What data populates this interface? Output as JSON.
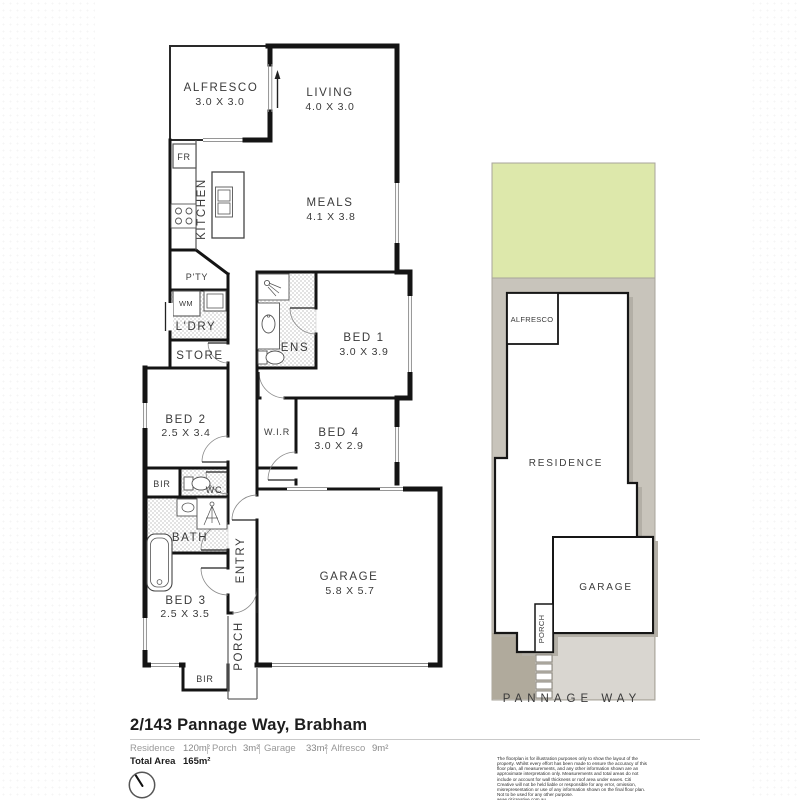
{
  "floorplan": {
    "alfresco": {
      "name": "ALFRESCO",
      "dims": "3.0 X 3.0"
    },
    "living": {
      "name": "LIVING",
      "dims": "4.0 X 3.0"
    },
    "meals": {
      "name": "MEALS",
      "dims": "4.1 X 3.8"
    },
    "kitchen": "KITCHEN",
    "fridge": "FR",
    "pantry": "P'TY",
    "washing_machine": "WM",
    "laundry": "L'DRY",
    "store": "STORE",
    "bed1": {
      "name": "BED 1",
      "dims": "3.0 X 3.9"
    },
    "ensuite": "ENS",
    "bed2": {
      "name": "BED 2",
      "dims": "2.5 X 3.4"
    },
    "wir": "W.I.R",
    "bed4": {
      "name": "BED 4",
      "dims": "3.0 X 2.9"
    },
    "bir_bed2": "BIR",
    "wc": "WC",
    "bath": "BATH",
    "entry": "ENTRY",
    "bed3": {
      "name": "BED 3",
      "dims": "2.5 X 3.5"
    },
    "porch": "PORCH",
    "bir_bed3": "BIR",
    "garage": {
      "name": "GARAGE",
      "dims": "5.8 X 5.7"
    }
  },
  "siteplan": {
    "alfresco": "ALFRESCO",
    "residence": "RESIDENCE",
    "garage": "GARAGE",
    "porch": "PORCH",
    "street": "PANNAGE WAY"
  },
  "footer": {
    "title": "2/143 Pannage Way, Brabham",
    "areas": [
      {
        "label": "Residence",
        "value": "120m²"
      },
      {
        "label": "Porch",
        "value": "3m²"
      },
      {
        "label": "Garage",
        "value": "33m²"
      },
      {
        "label": "Alfresco",
        "value": "9m²"
      }
    ],
    "total_label": "Total Area",
    "total_value": "165m²",
    "disclaimer": "The floorplan is for illustration purposes only to show the layout of the property. Whilst every effort has been made to ensure the accuracy of this floor plan, all measurements, and any other information shown are an approximate interpretation only. Measurements and total areas do not include or account for wall thickness or roof area under eaves. Citi Creative will not be held liable or responsible for any error, omission, misrepresentation or use of any information shown on the final floor plan. Not to be used for any other purpose.\nwww.citicreative.com.au"
  },
  "colors": {
    "wall": "#141414",
    "grass": "#dde8ab",
    "lot": "#c8c4bb",
    "lot_light": "#d9d6d0",
    "driveway": "#b0aa9c"
  }
}
